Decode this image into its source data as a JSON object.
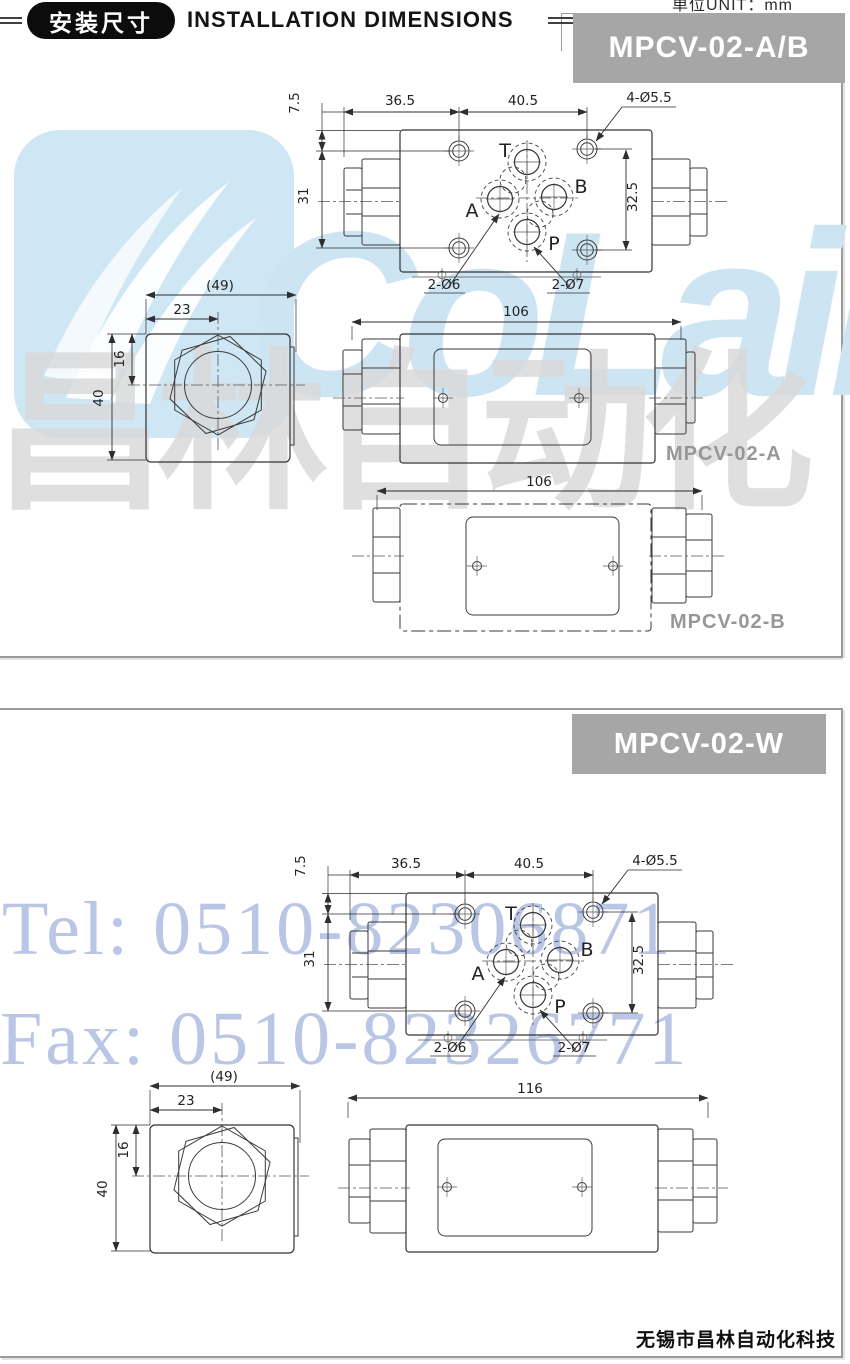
{
  "header": {
    "badge": "安装尺寸",
    "title": "INSTALLATION DIMENSIONS",
    "unit": "单位UNIT：mm"
  },
  "panels": {
    "ab": {
      "banner": "MPCV-02-A/B"
    },
    "w": {
      "banner": "MPCV-02-W"
    }
  },
  "drawings": {
    "top_view": {
      "d_7_5": "7.5",
      "d_36_5": "36.5",
      "d_40_5": "40.5",
      "holes_note": "4-Ø5.5",
      "d_31": "31",
      "d_32_5": "32.5",
      "pin_note_6": "2-Ø6",
      "pin_note_7": "2-Ø7",
      "port_t": "T",
      "port_a": "A",
      "port_b": "B",
      "port_p": "P"
    },
    "end_view": {
      "d_49": "(49)",
      "d_23": "23",
      "d_16": "16",
      "d_40": "40"
    },
    "front_view_a": {
      "d_106": "106",
      "label": "MPCV-02-A"
    },
    "front_view_b": {
      "d_106": "106",
      "label": "MPCV-02-B"
    },
    "front_view_w": {
      "d_116": "116"
    }
  },
  "watermarks": {
    "logo_text": "CoLair",
    "logo_cjk": "昌林自动化",
    "tel": "Tel: 0510-82306871",
    "fax": "Fax: 0510-82326771"
  },
  "footer": {
    "company": "无锡市昌林自动化科技"
  },
  "colors": {
    "banner_gray": "#a6a6a6",
    "label_gray": "#979797",
    "watermark_blue": "#cfe7f5",
    "watermark_text_blue": "#cde4f3",
    "watermark_gray": "#dadada",
    "contact_blue": "#a9b8e0",
    "line_dark": "#3a3a3a"
  }
}
